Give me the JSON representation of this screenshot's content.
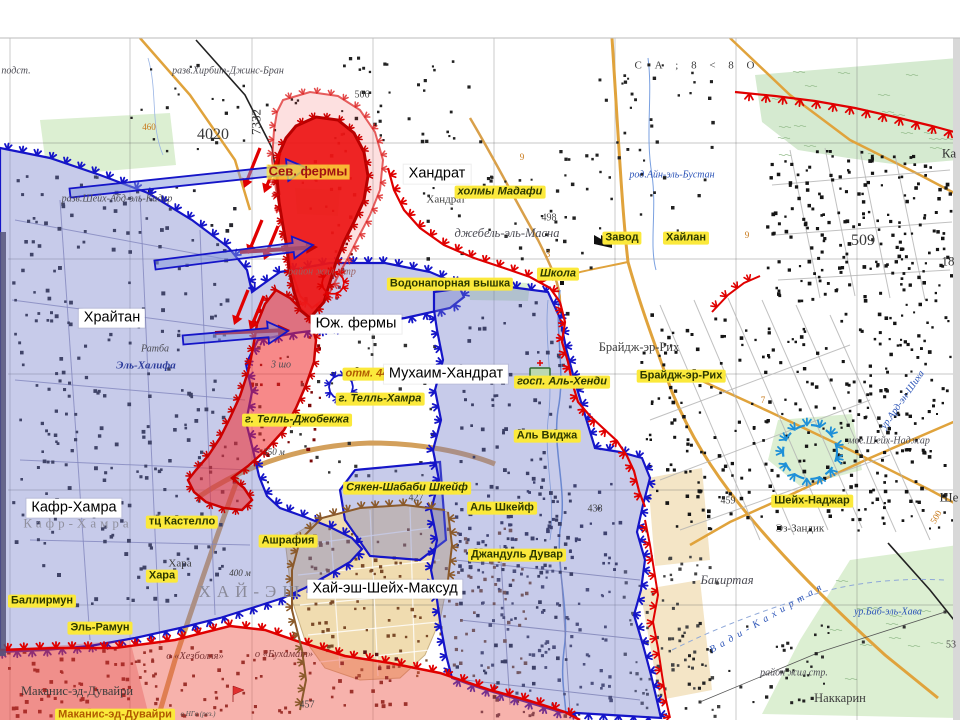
{
  "colors": {
    "blue_zone_fill": "#6c76c8",
    "blue_line": "#1515c8",
    "red_zone_fill": "#ed1515",
    "red_line": "#e00000",
    "salmon_zone_fill": "#ee5446",
    "brown_line": "#8b5a2b",
    "light_blue_circle": "#1e90d8",
    "yellow_label_bg": "#fbe93b",
    "road_orange": "#e0a33c",
    "green_area": "#dcefd2",
    "tan_area": "#f0dcb0"
  },
  "labels": {
    "items": [
      {
        "t": "Кафр-Хамра",
        "x": 78,
        "y": 524,
        "c": "un"
      },
      {
        "t": "ХАЙ-ЭШ",
        "x": 252,
        "y": 592,
        "c": "un unl"
      },
      {
        "t": "разв.Хирбит-Джинс-Бран",
        "x": 228,
        "y": 71,
        "c": "gi"
      },
      {
        "t": "подст.",
        "x": 16,
        "y": 71,
        "c": "gi"
      },
      {
        "t": "разв.Шейх-Абд-эль-Кадир",
        "x": 117,
        "y": 199,
        "c": "gi"
      },
      {
        "t": "Хандрат",
        "x": 446,
        "y": 200,
        "c": "g"
      },
      {
        "t": "джебель-эль-Масна",
        "x": 507,
        "y": 233,
        "c": "gi lg"
      },
      {
        "t": "род.Айн-эль-Бустан",
        "x": 672,
        "y": 175,
        "c": "bi"
      },
      {
        "t": "С А ; 8 < 8 О",
        "x": 697,
        "y": 66,
        "c": "g sp"
      },
      {
        "t": "Ратба",
        "x": 155,
        "y": 349,
        "c": "gi"
      },
      {
        "t": "Эль-Халифа",
        "x": 146,
        "y": 366,
        "c": "bb"
      },
      {
        "t": "район жил. стр",
        "x": 322,
        "y": 272,
        "c": "ri"
      },
      {
        "t": "3 шо",
        "x": 281,
        "y": 365,
        "c": "gi"
      },
      {
        "t": "350 м",
        "x": 274,
        "y": 452,
        "c": "gs"
      },
      {
        "t": "400 м",
        "x": 240,
        "y": 573,
        "c": "gs"
      },
      {
        "t": "Хара",
        "x": 180,
        "y": 564,
        "c": "g"
      },
      {
        "t": "Брайдж-эр-Рих",
        "x": 639,
        "y": 347,
        "c": "g lg"
      },
      {
        "t": "мог.Шейх-Наджар",
        "x": 889,
        "y": 441,
        "c": "gi"
      },
      {
        "t": "Эз-Зандик",
        "x": 800,
        "y": 529,
        "c": "g"
      },
      {
        "t": "Бакиртая",
        "x": 727,
        "y": 580,
        "c": "gi lg"
      },
      {
        "t": "Вади-Кахиртая",
        "x": 768,
        "y": 618,
        "c": "bi sp",
        "r": -30
      },
      {
        "t": "ур.Баб-эль-Хава",
        "x": 888,
        "y": 612,
        "c": "bi"
      },
      {
        "t": "ур.Ард-эн-Шиха",
        "x": 903,
        "y": 400,
        "c": "bi",
        "r": -55
      },
      {
        "t": "район жил.стр.",
        "x": 794,
        "y": 673,
        "c": "gi"
      },
      {
        "t": "Наккарин",
        "x": 840,
        "y": 698,
        "c": "g lg"
      },
      {
        "t": "Маканис-эд-Дувайри",
        "x": 77,
        "y": 691,
        "c": "g lg"
      },
      {
        "t": "о «Хезболля»",
        "x": 195,
        "y": 657,
        "c": "dri"
      },
      {
        "t": "о «Бухамат»",
        "x": 284,
        "y": 655,
        "c": "dri"
      },
      {
        "t": "о НГа (рез.)",
        "x": 198,
        "y": 714,
        "c": "ti"
      },
      {
        "t": "4020",
        "x": 213,
        "y": 135,
        "c": "nb"
      },
      {
        "t": "7332",
        "x": 257,
        "y": 122,
        "c": "n",
        "r": -90
      },
      {
        "t": "506",
        "x": 362,
        "y": 95,
        "c": "ns"
      },
      {
        "t": "498",
        "x": 549,
        "y": 218,
        "c": "ns"
      },
      {
        "t": "509",
        "x": 863,
        "y": 241,
        "c": "nb"
      },
      {
        "t": "459",
        "x": 728,
        "y": 501,
        "c": "ns"
      },
      {
        "t": "438",
        "x": 595,
        "y": 509,
        "c": "ns"
      },
      {
        "t": "427",
        "x": 416,
        "y": 498,
        "c": "ns"
      },
      {
        "t": "457",
        "x": 307,
        "y": 705,
        "c": "ns"
      },
      {
        "t": "460",
        "x": 149,
        "y": 127,
        "c": "onum"
      },
      {
        "t": "500",
        "x": 936,
        "y": 517,
        "c": "onum",
        "r": -60
      },
      {
        "t": "9",
        "x": 522,
        "y": 157,
        "c": "onum"
      },
      {
        "t": "9",
        "x": 747,
        "y": 235,
        "c": "onum"
      },
      {
        "t": "3",
        "x": 548,
        "y": 254,
        "c": "onum"
      },
      {
        "t": "7",
        "x": 763,
        "y": 400,
        "c": "onum"
      },
      {
        "t": "18",
        "x": 948,
        "y": 262,
        "c": "n"
      },
      {
        "t": "53",
        "x": 951,
        "y": 645,
        "c": "ns"
      },
      {
        "t": "Ка",
        "x": 949,
        "y": 154,
        "c": "n"
      },
      {
        "t": "Ше",
        "x": 949,
        "y": 498,
        "c": "n"
      },
      {
        "t": "Сев. фермы",
        "x": 308,
        "y": 172,
        "c": "sev"
      },
      {
        "t": "холмы Мадафи",
        "x": 500,
        "y": 192,
        "c": "yellow it"
      },
      {
        "t": "Завод",
        "x": 622,
        "y": 238,
        "c": "yellow"
      },
      {
        "t": "Хайлан",
        "x": 686,
        "y": 238,
        "c": "yellow"
      },
      {
        "t": "Школа",
        "x": 558,
        "y": 274,
        "c": "yellow it"
      },
      {
        "t": "Водонапорная вышка",
        "x": 450,
        "y": 284,
        "c": "yellow"
      },
      {
        "t": "Брайдж-эр-Рих",
        "x": 681,
        "y": 376,
        "c": "yellow"
      },
      {
        "t": "отм. 445",
        "x": 370,
        "y": 374,
        "c": "yellow it yor"
      },
      {
        "t": "г. Телль-Хамра",
        "x": 380,
        "y": 399,
        "c": "yellow it"
      },
      {
        "t": "г. Телль-Джобекжа",
        "x": 297,
        "y": 420,
        "c": "yellow it"
      },
      {
        "t": "госп. Аль-Хенди",
        "x": 562,
        "y": 382,
        "c": "yellow it"
      },
      {
        "t": "Аль Виджа",
        "x": 547,
        "y": 436,
        "c": "yellow"
      },
      {
        "t": "Шейх-Наджар",
        "x": 812,
        "y": 501,
        "c": "yellow"
      },
      {
        "t": "Сякен-Шабаби Шкейф",
        "x": 407,
        "y": 488,
        "c": "yellow it"
      },
      {
        "t": "Аль Шкейф",
        "x": 502,
        "y": 508,
        "c": "yellow"
      },
      {
        "t": "Джандуль Дувар",
        "x": 517,
        "y": 555,
        "c": "yellow"
      },
      {
        "t": "тц Кастелло",
        "x": 182,
        "y": 522,
        "c": "yellow"
      },
      {
        "t": "Ашрафия",
        "x": 288,
        "y": 541,
        "c": "yellow"
      },
      {
        "t": "Хара",
        "x": 162,
        "y": 576,
        "c": "yellow"
      },
      {
        "t": "Баллирмун",
        "x": 42,
        "y": 601,
        "c": "yellow"
      },
      {
        "t": "Эль-Рамун",
        "x": 100,
        "y": 628,
        "c": "yellow"
      },
      {
        "t": "Маканис-эд-Дувайри",
        "x": 115,
        "y": 715,
        "c": "yellow yor"
      },
      {
        "t": "Хандрат",
        "x": 437,
        "y": 174,
        "c": "white"
      },
      {
        "t": "Храйтан",
        "x": 112,
        "y": 318,
        "c": "white"
      },
      {
        "t": "Юж. фермы",
        "x": 356,
        "y": 324,
        "c": "white"
      },
      {
        "t": "Мухаим-Хандрат",
        "x": 446,
        "y": 374,
        "c": "white"
      },
      {
        "t": "Кафр-Хамра",
        "x": 74,
        "y": 508,
        "c": "white"
      },
      {
        "t": "Хай-эш-Шейх-Максуд",
        "x": 385,
        "y": 589,
        "c": "white"
      }
    ]
  }
}
